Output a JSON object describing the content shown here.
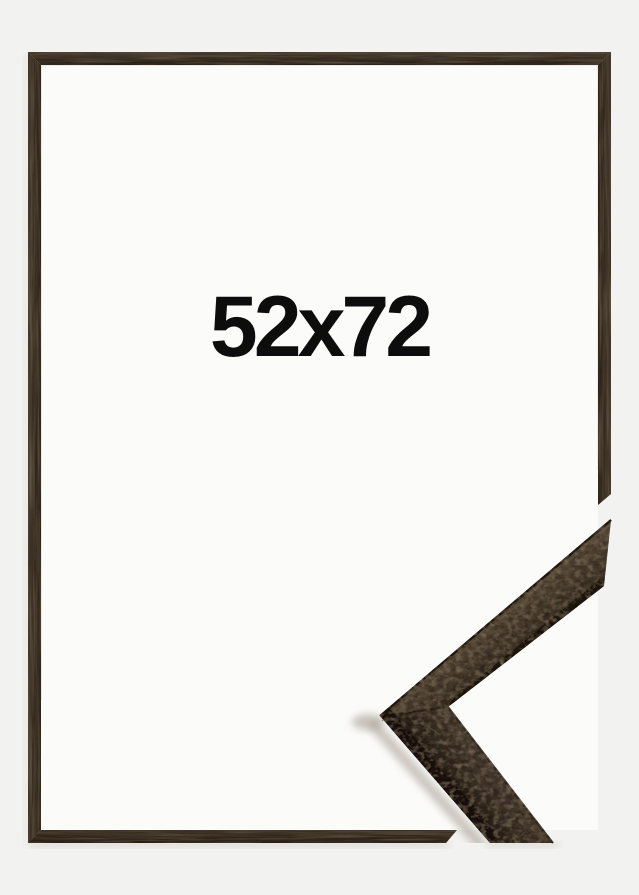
{
  "product": {
    "size_label": "52x72"
  },
  "colors": {
    "background": "#f2f2f1",
    "inner_background": "#fbfbfa",
    "label_text": "#0d0d0d",
    "frame_wood": "#40352a",
    "frame_wood_dark": "#2b231c",
    "frame_wood_light": "#55483a",
    "sample_wood": "#473c30",
    "sample_wood_light": "#60523f",
    "sample_wood_dark": "#1d1711"
  }
}
